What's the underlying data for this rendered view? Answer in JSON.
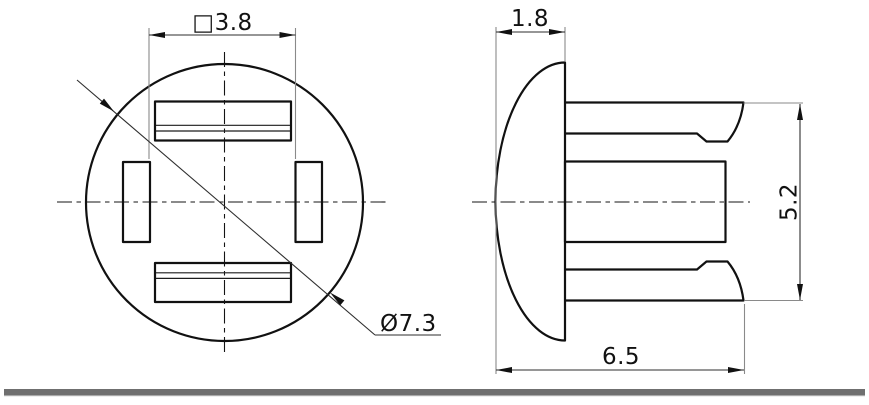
{
  "drawing": {
    "dimensions": {
      "square_width": {
        "label": "□3.8",
        "value": "3.8",
        "meaning": "square-opening-width"
      },
      "head_height": {
        "label": "1.8",
        "value": "1.8",
        "meaning": "dome-head-height"
      },
      "barb_span": {
        "label": "5.2",
        "value": "5.2",
        "meaning": "barb-outer-span"
      },
      "overall_length": {
        "label": "6.5",
        "value": "6.5",
        "meaning": "overall-length"
      },
      "head_diameter": {
        "label": "Ø7.3",
        "value": "7.3",
        "meaning": "head-diameter"
      }
    },
    "colors": {
      "outline": "#111111",
      "dimension_line": "#2e2e2e",
      "extension_line": "#8a8a8a",
      "baseline_bar": "#6f6f6f",
      "background": "#ffffff"
    }
  }
}
